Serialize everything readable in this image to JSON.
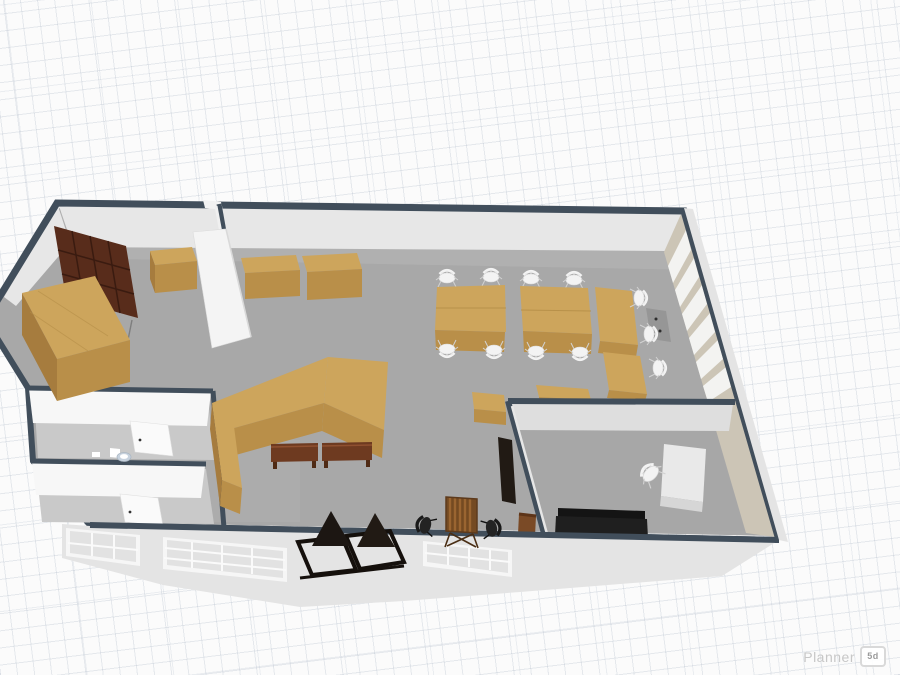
{
  "ui": {
    "watermark": {
      "brand": "Planner",
      "badge": "5d"
    }
  },
  "colors": {
    "bg": "#fbfbfb",
    "grid": "rgba(178,188,202,0.30)",
    "edge": "#414e5b",
    "wall_face": "#e7e7e7",
    "wall_face_dark": "#dedede",
    "white_wall": "#f7f7f7",
    "tan_wall": "#ccc5b6",
    "white_panel": "#f3f3f1",
    "exterior_wall": "#e4e4e4",
    "window_pane": "#e2e2e2",
    "floor": "#a8a8a8",
    "floor_bath": "#c9c9c9",
    "wood_top": "#cda55c",
    "wood_front": "#b98f49",
    "wood_side": "#a67c3e",
    "dark_rack": "#582c1b",
    "bench": "#6e3a20",
    "white_furniture": "#f3f3f3",
    "black_furniture": "#1d1d1d",
    "gray_cabinet": "#969696",
    "door_frame": "#15100c",
    "door_glass": "#42352a",
    "slat_light": "#9a6531",
    "slat_dark": "#744a22",
    "watermark_text": "#c7c7c7"
  }
}
